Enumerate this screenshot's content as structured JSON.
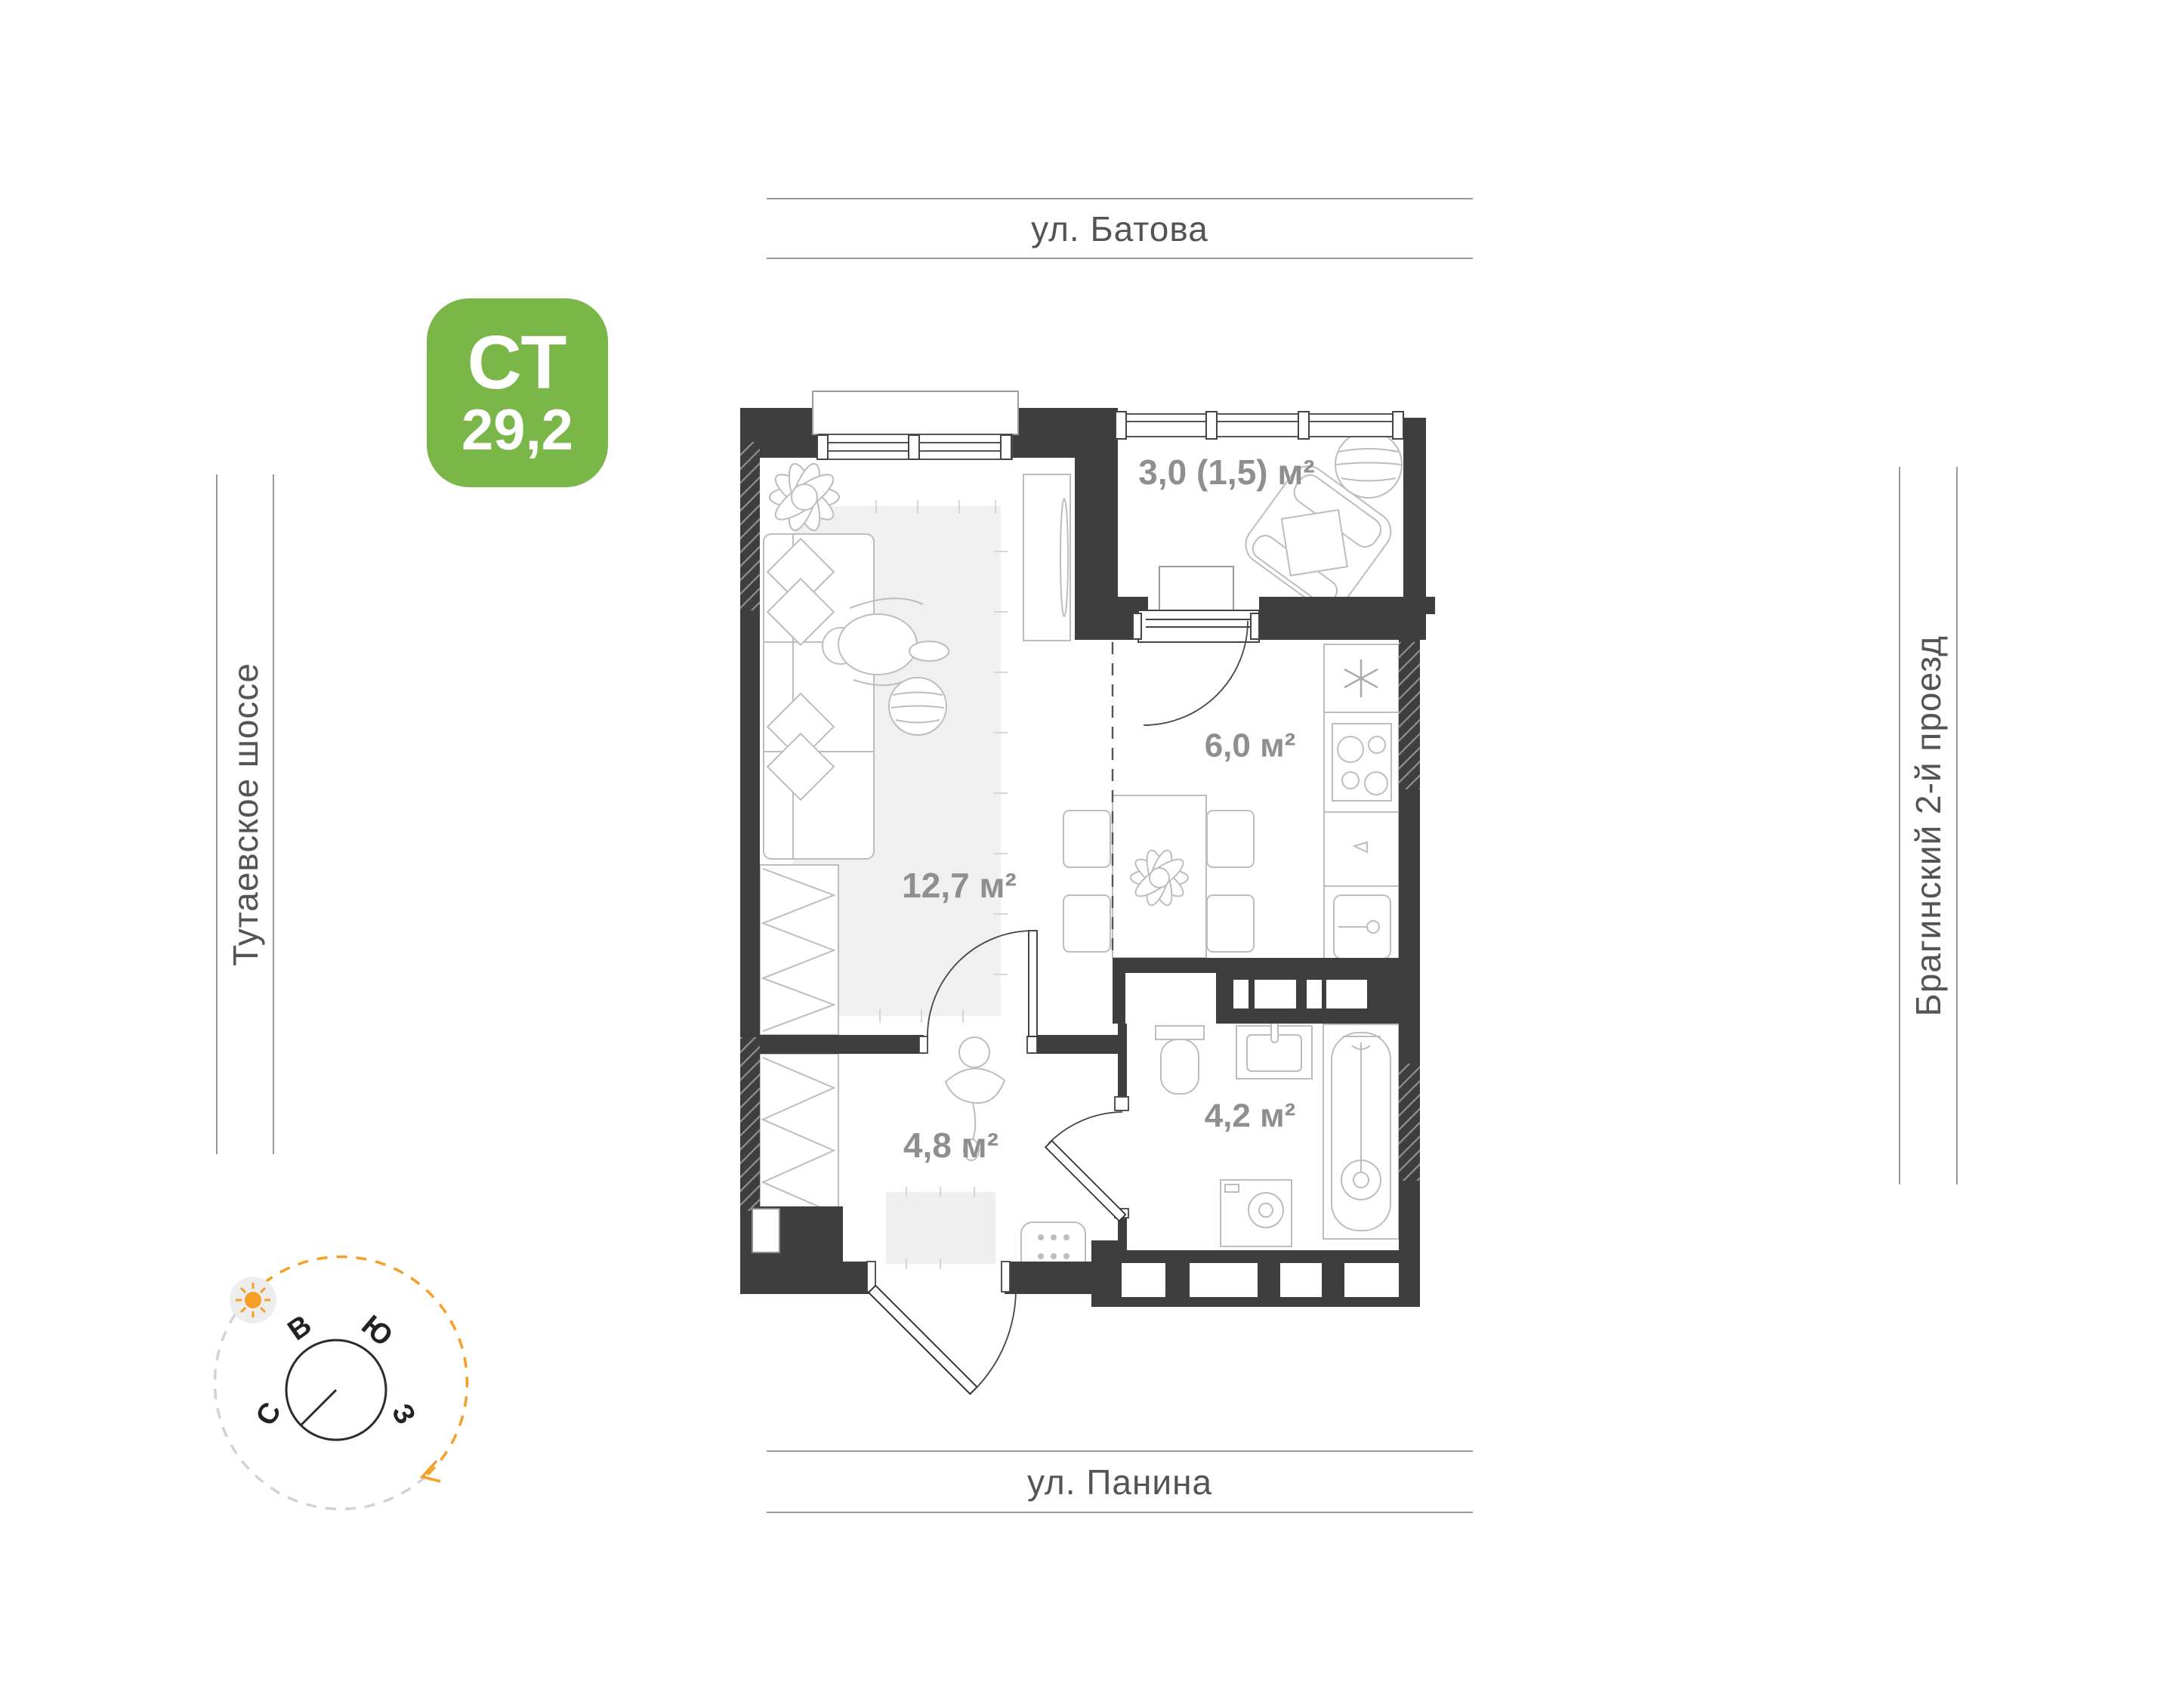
{
  "badge": {
    "type_label": "СТ",
    "area_value": "29,2"
  },
  "streets": {
    "top": "ул. Батова",
    "bottom": "ул. Панина",
    "left": "Тутаевское шоссе",
    "right": "Брагинский 2-й проезд"
  },
  "rooms": {
    "balcony": {
      "label": "3,0 (1,5) м²"
    },
    "kitchen": {
      "label": "6,0 м²"
    },
    "living": {
      "label": "12,7 м²"
    },
    "hallway": {
      "label": "4,8 м²"
    },
    "bathroom": {
      "label": "4,2 м²"
    }
  },
  "compass": {
    "east": "В",
    "south": "Ю",
    "north": "С",
    "west": "З"
  },
  "colors": {
    "wall": "#3e3e3e",
    "room_label": "#8f8f8f",
    "street_text": "#545454",
    "accent_green": "#7ab648",
    "compass_orange": "#f59f27"
  }
}
